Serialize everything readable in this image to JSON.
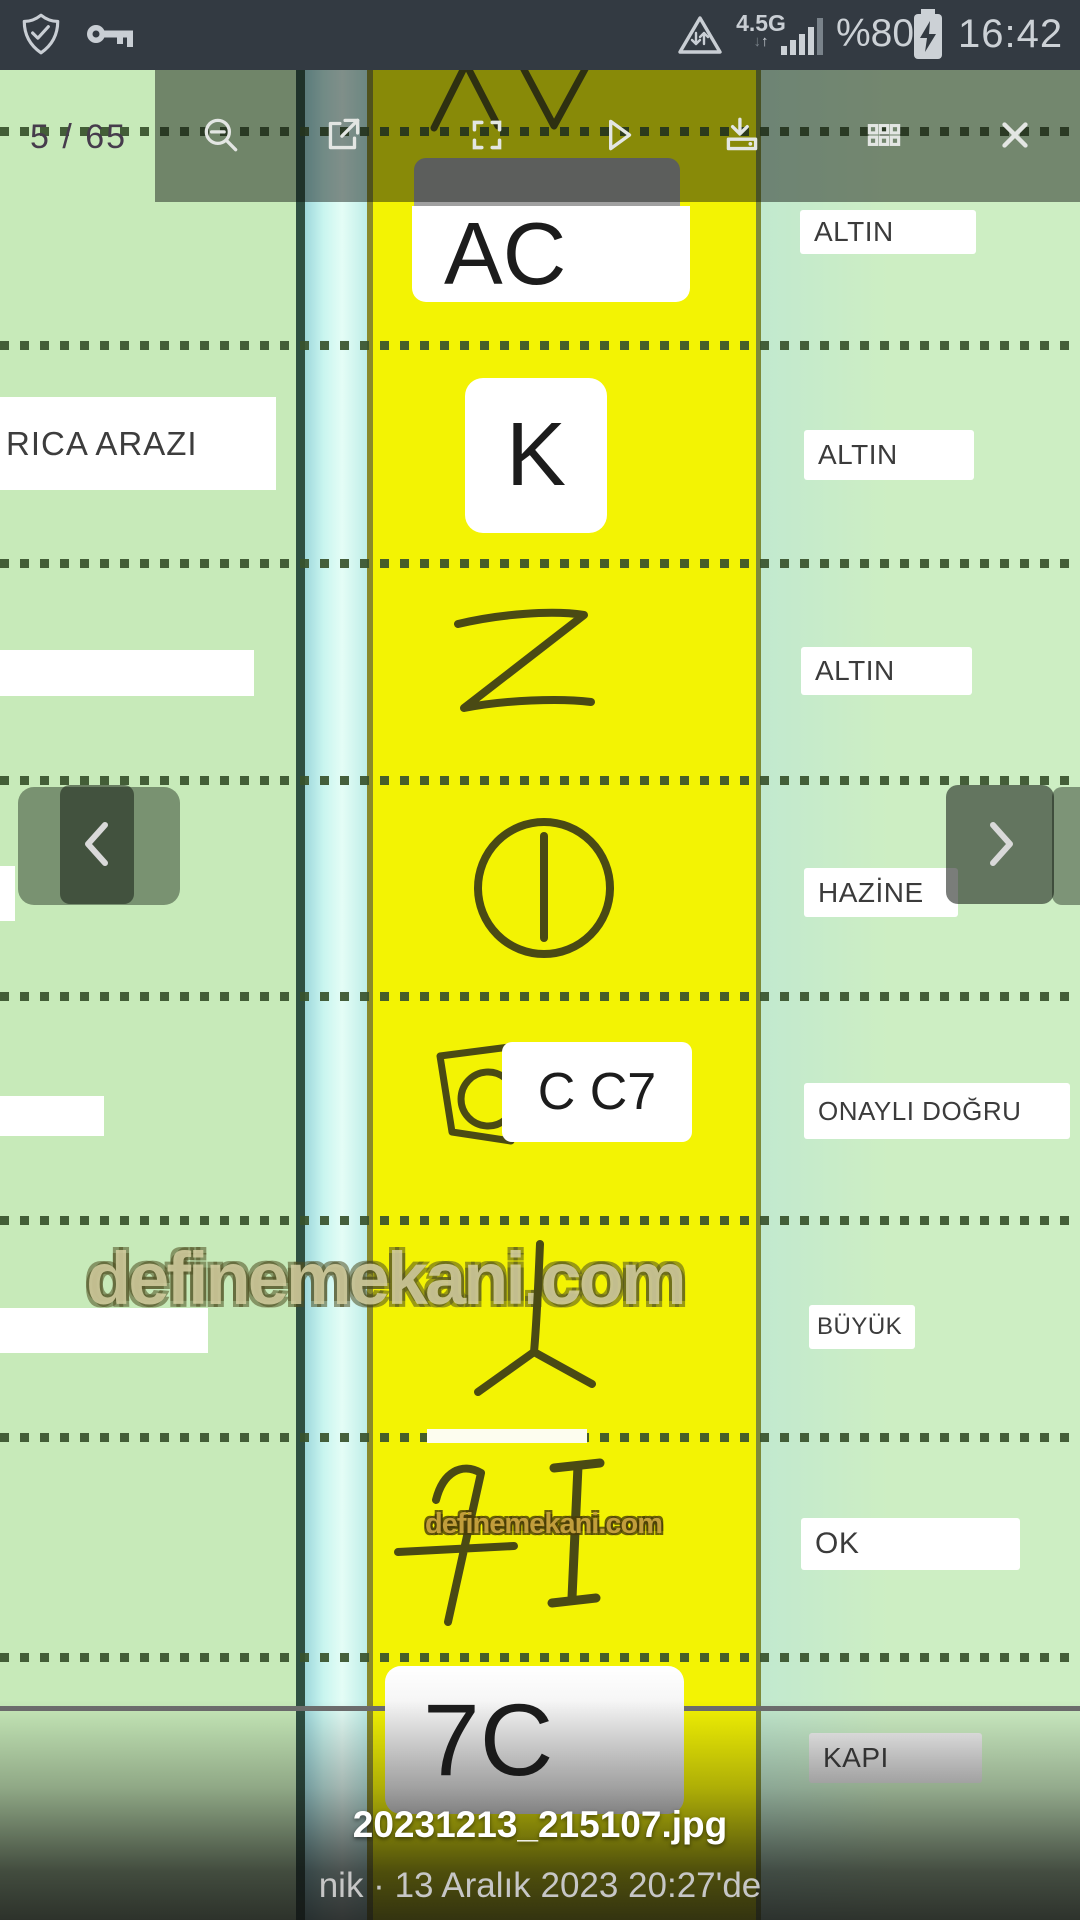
{
  "status_bar": {
    "time": "16:42",
    "battery": "%80",
    "network": "4.5G",
    "icons": [
      "shield-check",
      "key",
      "data-saver",
      "signal-strength",
      "battery-charging"
    ]
  },
  "toolbar": {
    "page_indicator": "5 / 65",
    "icons": [
      "zoom-out",
      "open-in-new",
      "fullscreen",
      "play",
      "download",
      "grid",
      "close"
    ]
  },
  "photo": {
    "left_labels": {
      "row2": "RICA ARAZI"
    },
    "symbols": {
      "row1": "AC",
      "row2": "K",
      "row5": "C C7",
      "row8": "7C"
    },
    "drawn_symbols": [
      "z-sign",
      "circle-with-line",
      "trapezoid-c",
      "forked-stake",
      "seven-and-i"
    ],
    "labels": [
      "ALTIN",
      "ALTIN",
      "ALTIN",
      "HAZİNE",
      "ONAYLI DOĞRU",
      "BÜYÜK",
      "OK",
      "KAPI"
    ]
  },
  "watermark": {
    "large": "definemekani.com",
    "small": "definemekani.com"
  },
  "caption": {
    "filename": "20231213_215107.jpg",
    "byline": "nik · 13 Aralık 2023 20:27'de"
  },
  "colors": {
    "yellow_strip": "#f3f303",
    "green_left": "#c7eab9",
    "green_right": "#c9edc9",
    "cyan_strip": "#cdf6ee",
    "status_bar": "#333a42",
    "overlay": "rgba(14,20,14,0.47)"
  }
}
